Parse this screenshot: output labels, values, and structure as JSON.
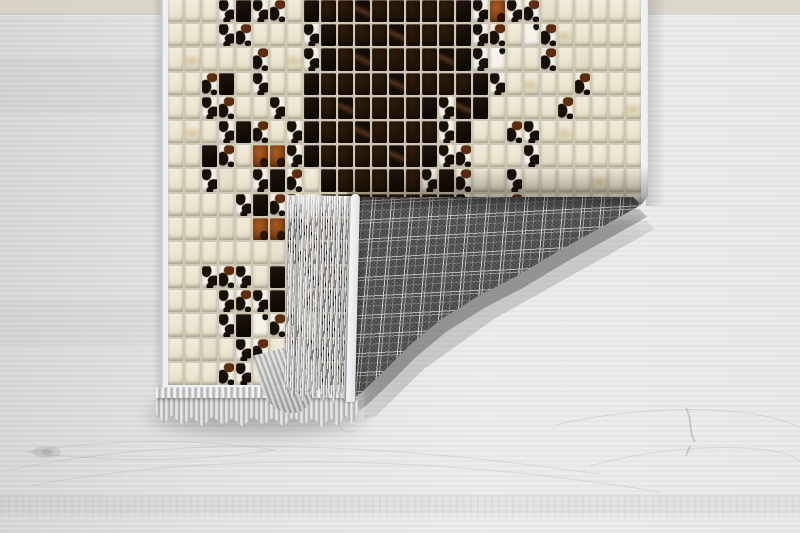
{
  "scene": {
    "kind": "product-photo",
    "description": "Patchwork cowhide-style rug with mosaic tile pattern, bottom-right corner folded over showing gray tartan plaid backing and gray fringe, lying on whitewashed wood plank floor",
    "floor": {
      "base": "#e3e3e3",
      "left_tone": "#d6d6d6",
      "right_tone": "#eeeeee",
      "plank_top_strip": "#d8d2c4",
      "grain_line": "#8a8a8a"
    },
    "rug": {
      "cols": 28,
      "rows": 16,
      "tile_types": {
        ".": "cream",
        ",": "cream2",
        "o": "stain",
        "W": "white",
        "S": "spotA",
        "Z": "spotB",
        "K": "black",
        "D": "dark",
        "E": "streak",
        "B": "brown"
      },
      "tile_map": [
        "...SKSZ.KDDEDDDDDKSBSZ,.....",
        "...SZ...SKDDDEDDDKSZ.WZo....",
        ".o...Z.oSKDEDDDDEKSW..Z.,...",
        "..ZK.S..KDDDDEDDDDKS.o..Z...",
        "..SZ..S.KDEDDDDKSEK....Z...o",
        ".o.SKZ.SKDDEDDDDSK..ZS.o....",
        "..KZ.BBSKDDDDEDKSZ...S,.....",
        "..S,.SKZ.KDDDKDSKZ..S....o..",
        "....SKZS,KDDDDDDKS..Z....o..",
        "...,.BBKZDDDDDDDKS.S........",
        "......,SZKDDDDDDSZ..........",
        "..SZS.K,SDDDDDDKSZ..........",
        "...SZSK.ZKDDDDDKSZ..........",
        "...SKWZS.KDDDDDKSZ..........",
        "..,.SZ.ZSKDDDDDKS...........",
        "...ZS.S,.KDDDDDKZ..........."
      ],
      "palette": {
        "cream1": "#ece6d2",
        "cream2": "#e4deca",
        "stain": "#d6c7a0",
        "white": "#f5f2e8",
        "spot": "#171008",
        "black1": "#211510",
        "black2": "#100a05",
        "dark1": "#2e1b0c",
        "dark2": "#140b05",
        "streak": "#50301a",
        "brown1": "#ad5a1e",
        "brown2": "#5f2d0e",
        "grout": "#cfc8b2",
        "binding": "#f0f1f3"
      }
    },
    "backing": {
      "pattern": "tartan-plaid",
      "plaidBase": "#4f4f4f",
      "plaidLine": "#d8d8d8"
    },
    "fringe": {
      "fLight": "#e8e8e8",
      "fMid": "#b9b9b9",
      "fDark": "#838383"
    }
  }
}
